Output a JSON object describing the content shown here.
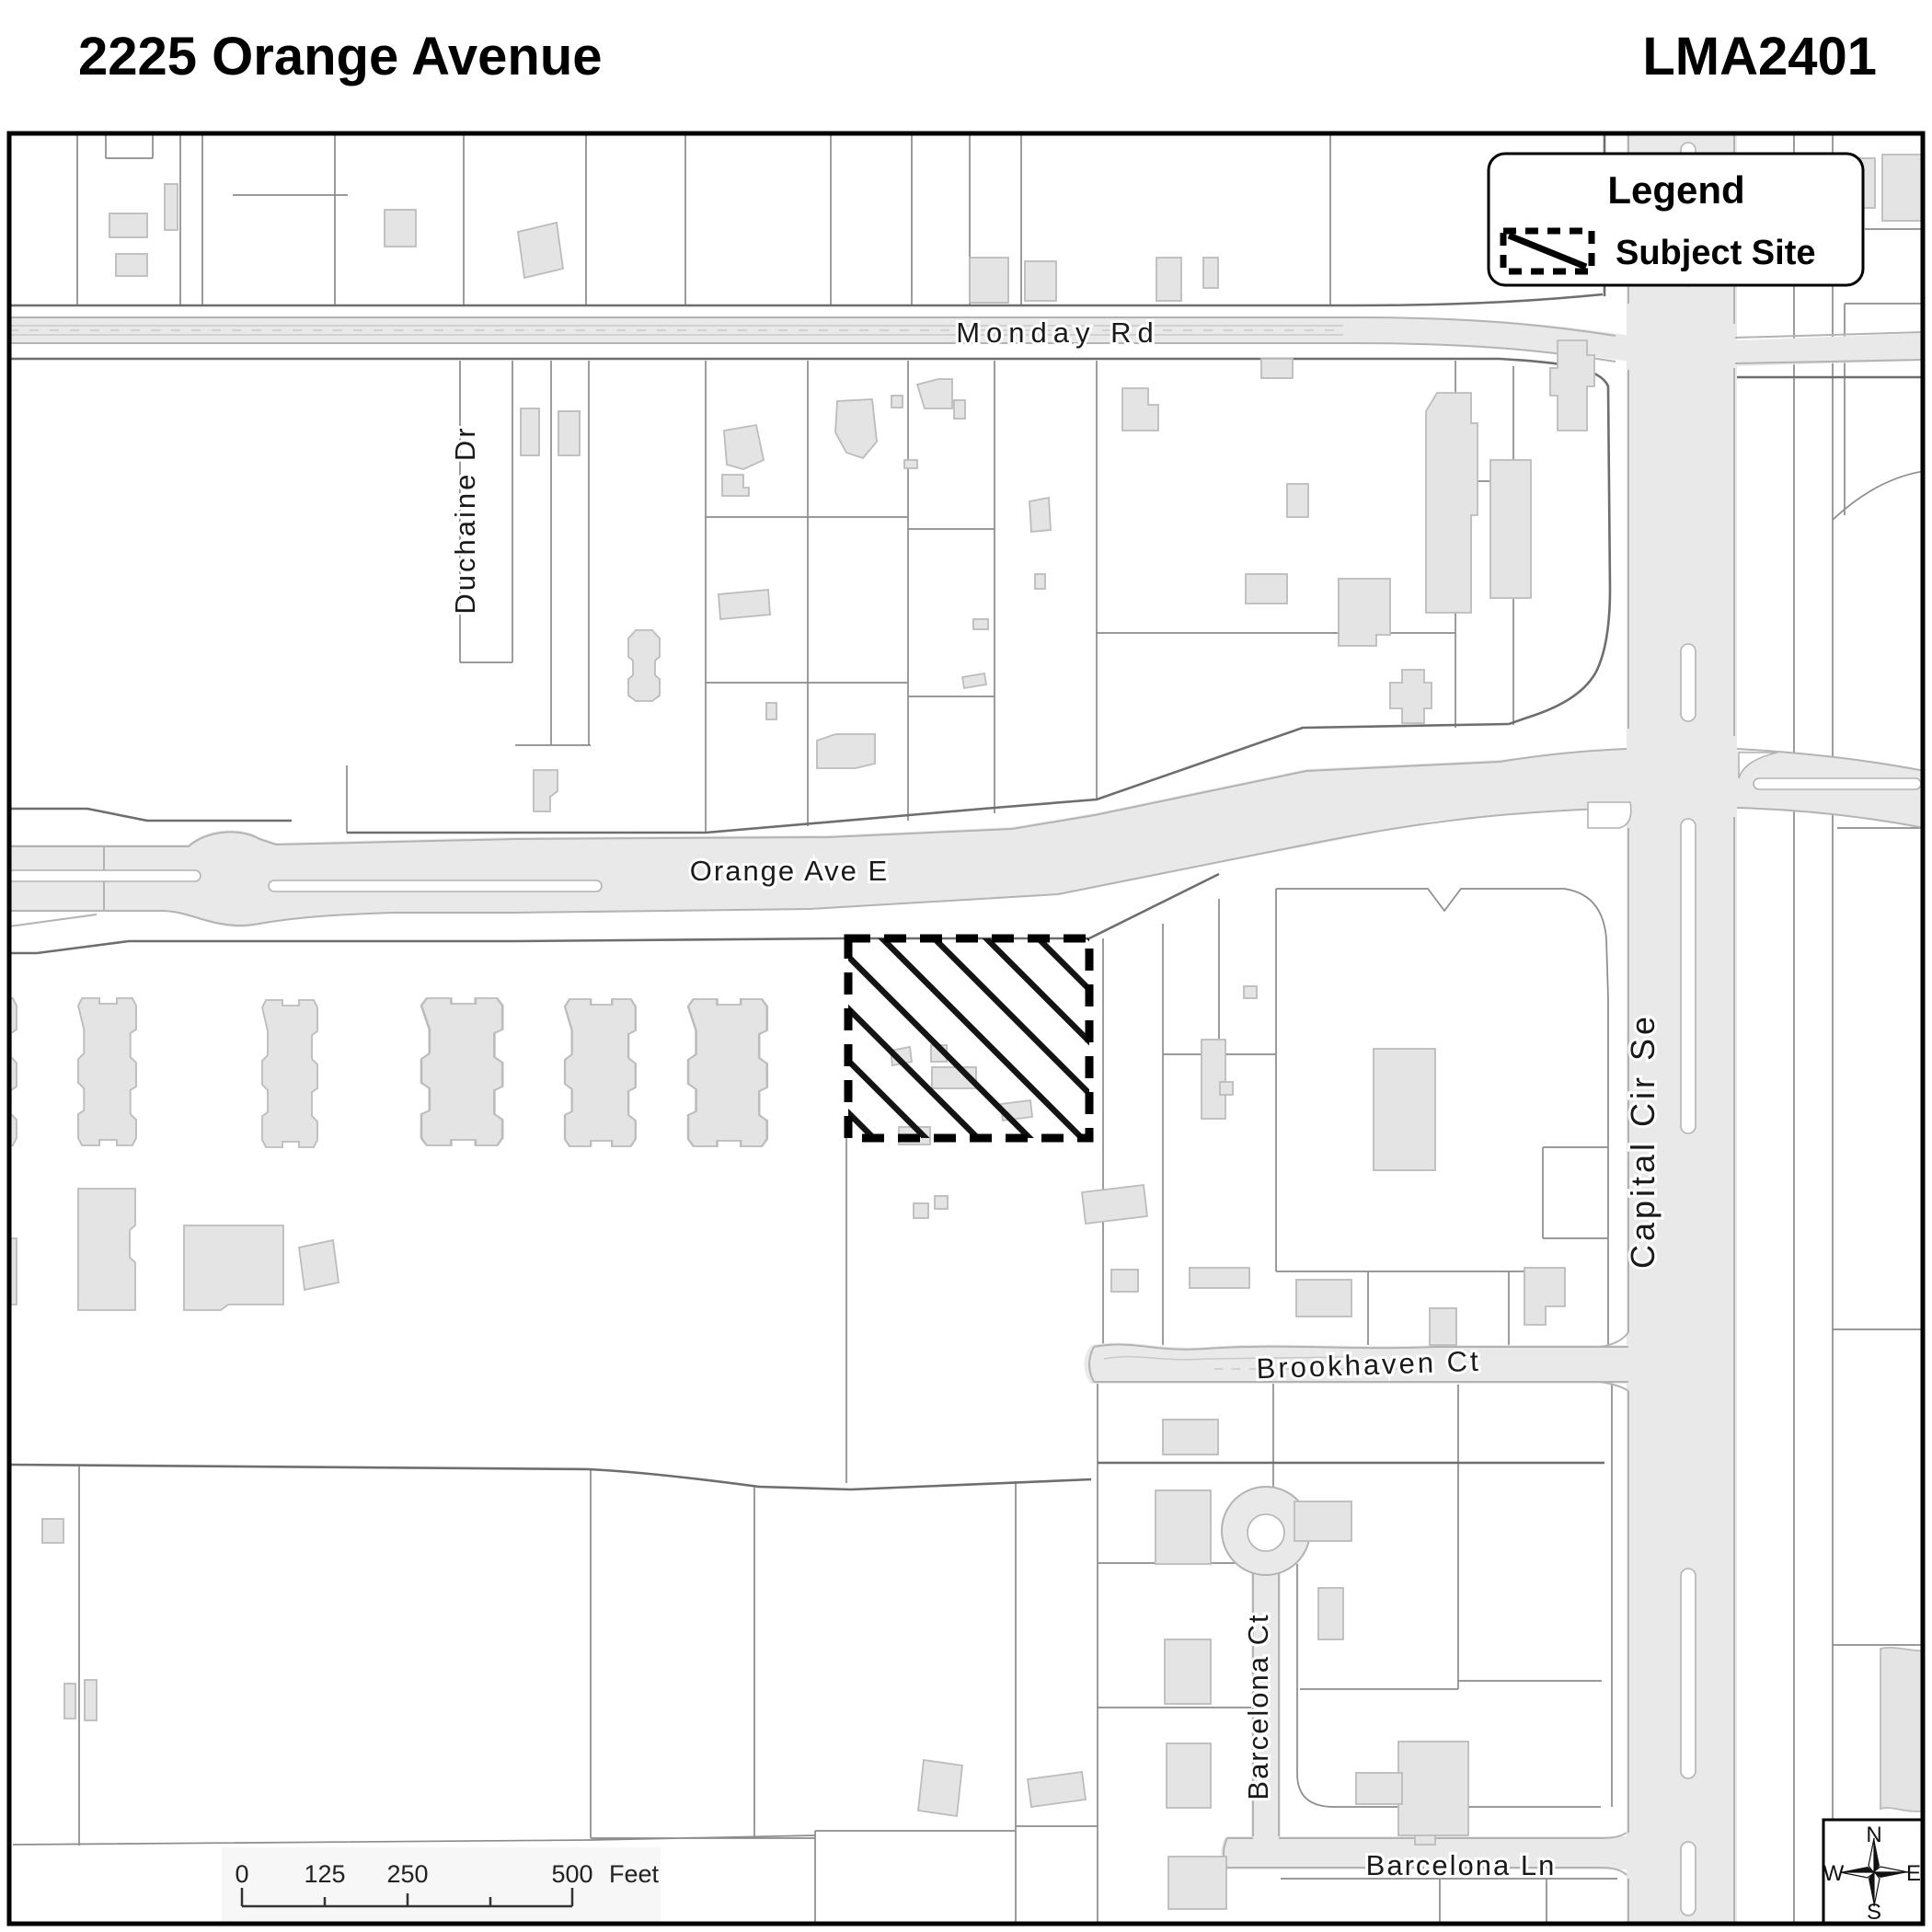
{
  "header": {
    "title": "2225 Orange Avenue",
    "case_number": "LMA2401"
  },
  "legend": {
    "title": "Legend",
    "subject_site_label": "Subject Site"
  },
  "roads": {
    "monday": "Monday Rd",
    "duchaine": "Duchaine Dr",
    "orange": "Orange Ave E",
    "capital": "Capital Cir Se",
    "brookhaven": "Brookhaven Ct",
    "barcelona_ct": "Barcelona Ct",
    "barcelona_ln": "Barcelona Ln"
  },
  "scale_bar": {
    "ticks": [
      "0",
      "125",
      "250",
      "500"
    ],
    "unit": "Feet"
  },
  "compass": {
    "north": "N",
    "south": "S",
    "east": "E",
    "west": "W"
  },
  "colors": {
    "road_fill": "#e9e9e9",
    "road_edge": "#b3b3b3",
    "parcel_line": "#8c8c8c",
    "frontage_line": "#6e6e6e",
    "building_fill": "#e4e4e4",
    "building_edge": "#bcbcbc",
    "subject_site_outline": "#000000"
  }
}
